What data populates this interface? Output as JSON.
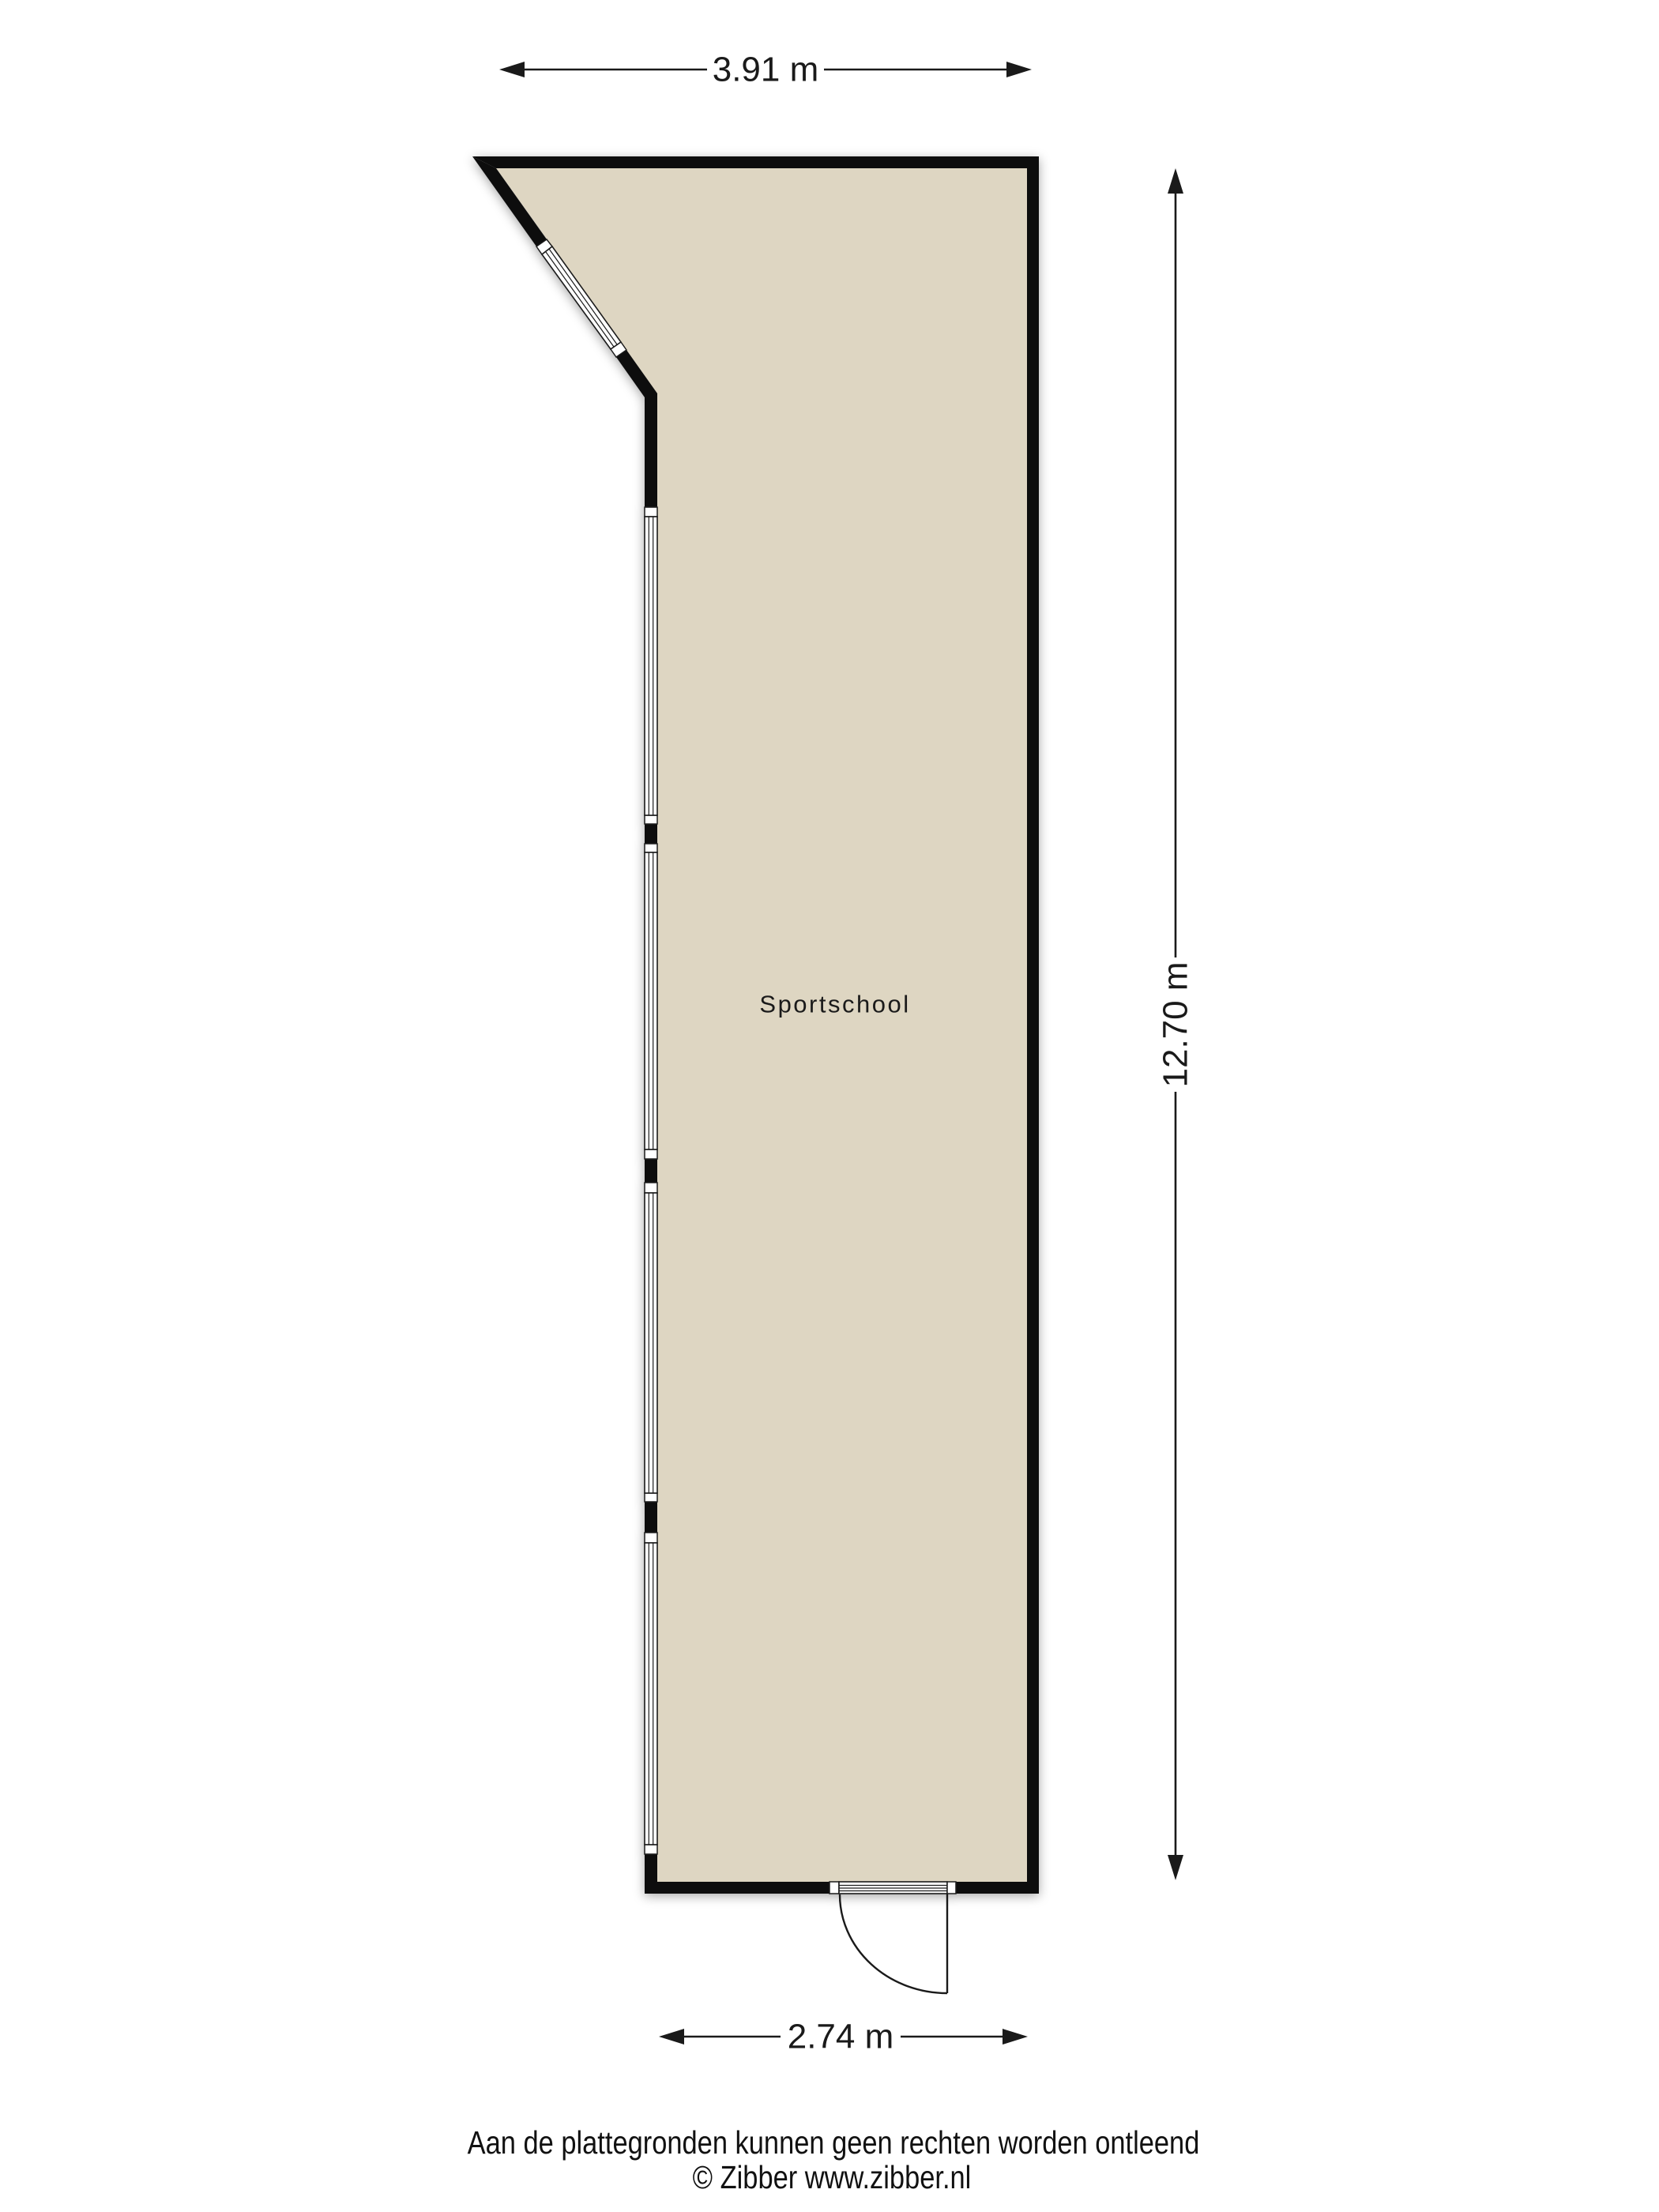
{
  "floorplan": {
    "room_label": "Sportschool",
    "dimensions": {
      "top": "3.91 m",
      "right": "12.70 m",
      "bottom": "2.74 m"
    },
    "colors": {
      "floor_fill": "#ded6c2",
      "wall": "#0a0a0a",
      "dimension": "#1a1a1a"
    }
  },
  "footer": {
    "disclaimer": "Aan de plattegronden kunnen geen rechten worden ontleend",
    "copyright": "© Zibber www.zibber.nl"
  }
}
